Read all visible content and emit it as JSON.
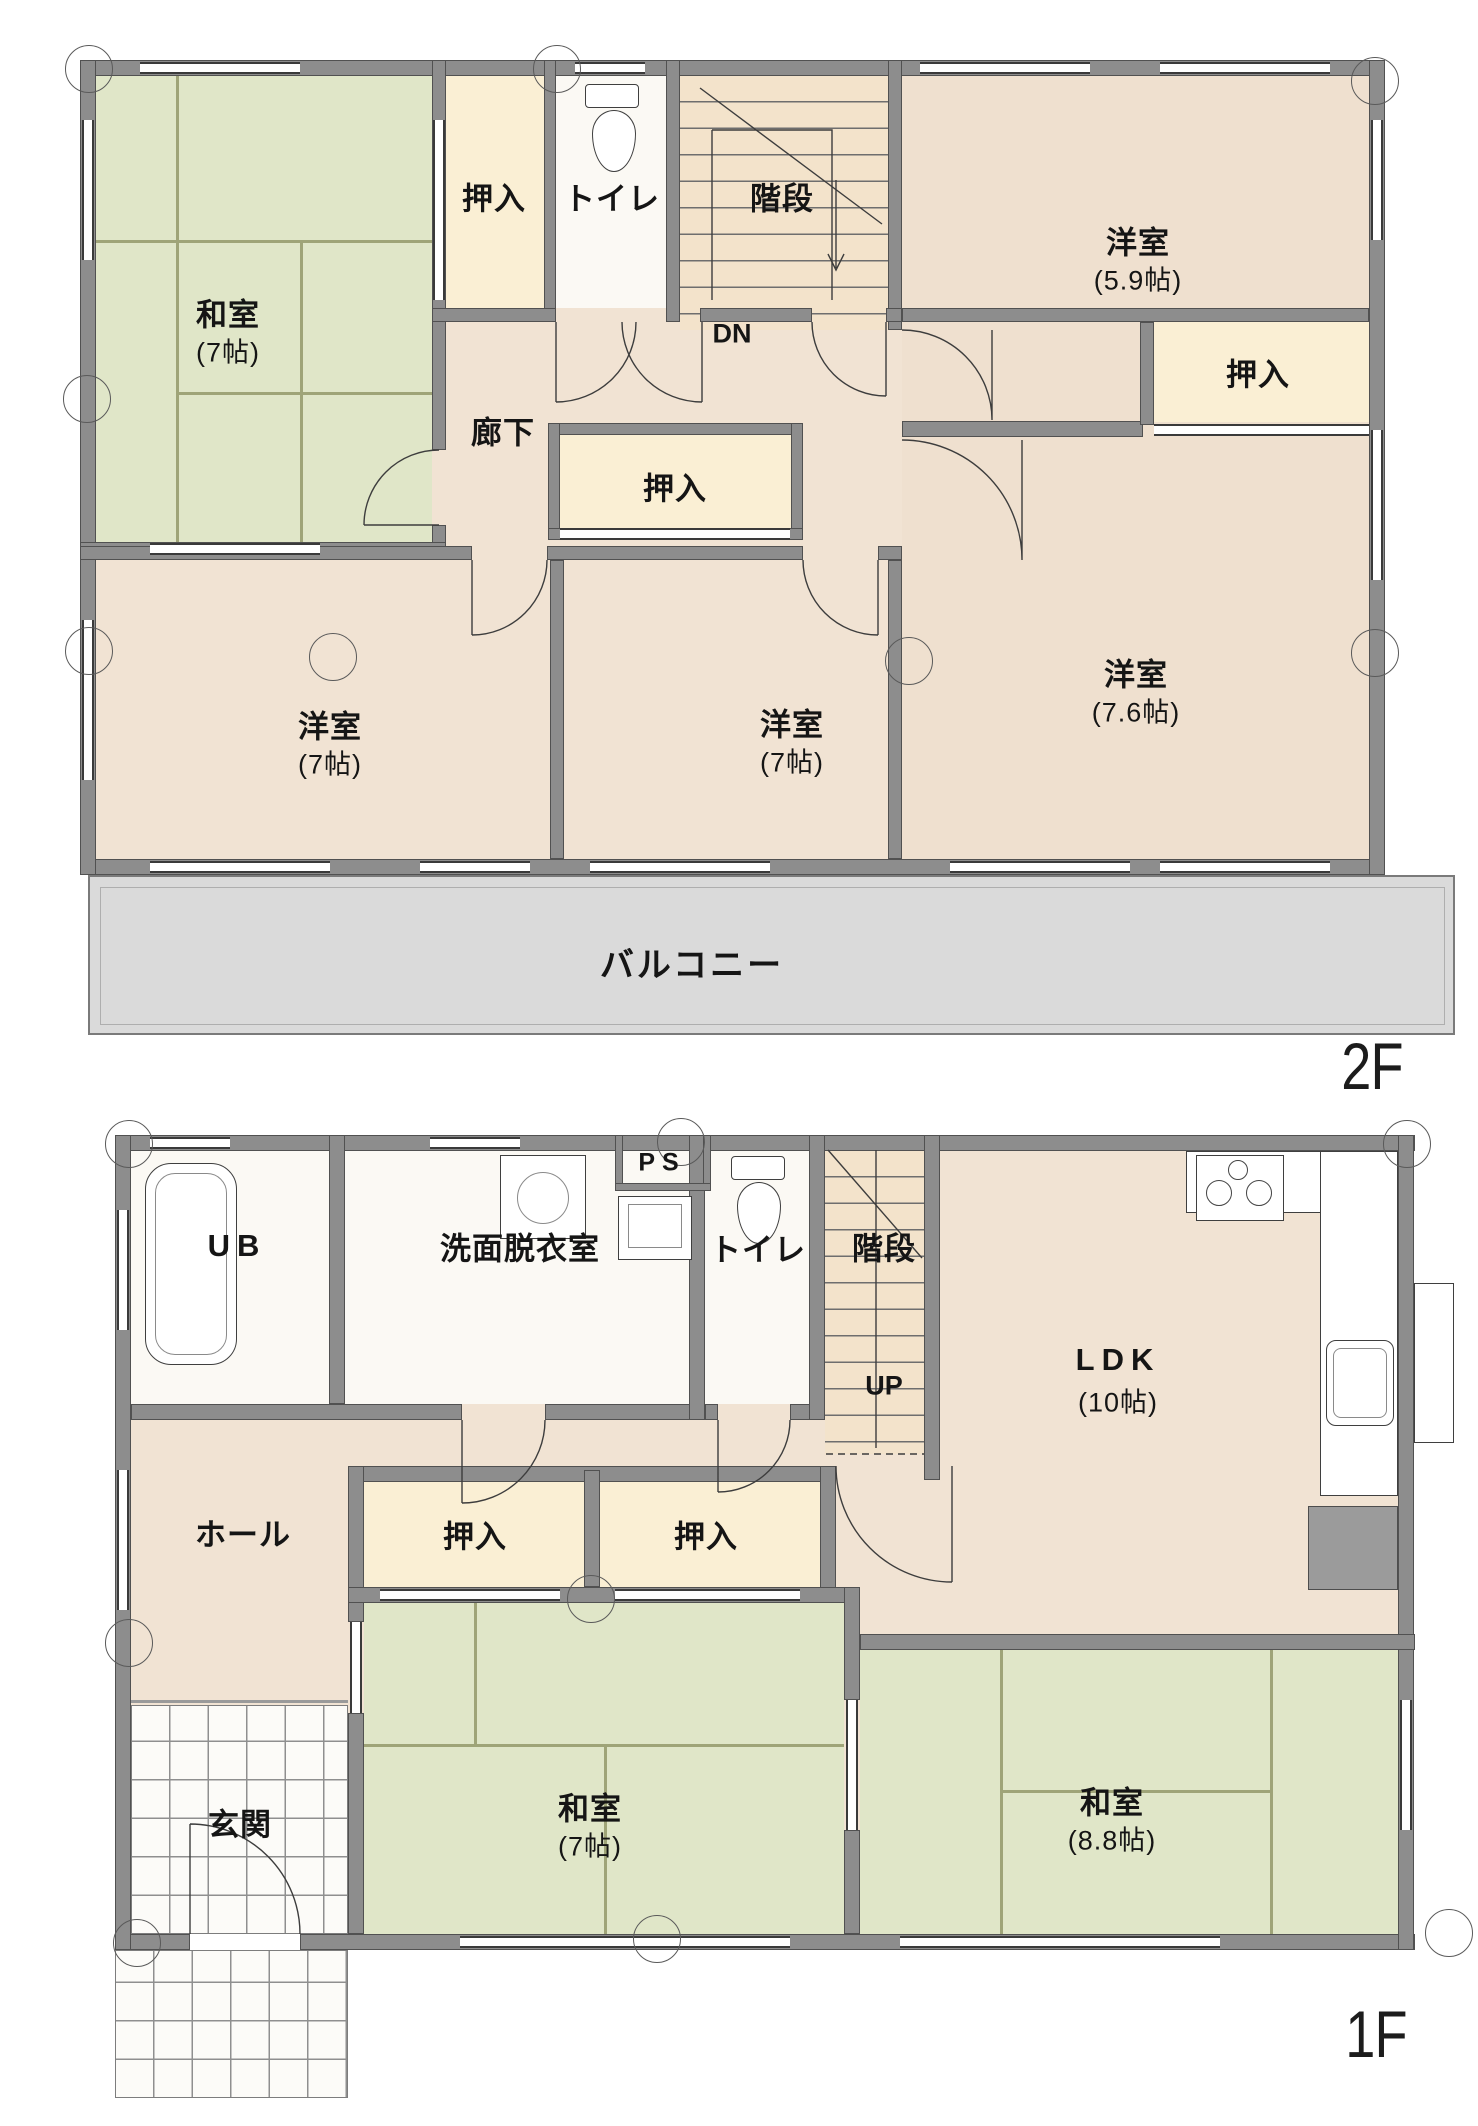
{
  "title": "間取り図",
  "colors": {
    "wall": "#8d8d8d",
    "tatami": "#e0e6c8",
    "wood_floor": "#f1e3d3",
    "closet": "#faefd4",
    "balcony": "#dadada",
    "white_room": "#fbf9f4"
  },
  "plan_2f": {
    "floor_label": "2F",
    "washitsu7": {
      "name": "和室",
      "size": "(7帖)"
    },
    "oshiire_top": {
      "name": "押入"
    },
    "toilet": {
      "name": "トイレ"
    },
    "stairs": {
      "name": "階段",
      "direction": "DN"
    },
    "rouka": {
      "name": "廊下"
    },
    "oshiire_mid": {
      "name": "押入"
    },
    "yoshitsu59": {
      "name": "洋室",
      "size": "(5.9帖)"
    },
    "oshiire_right": {
      "name": "押入"
    },
    "yoshitsu7a": {
      "name": "洋室",
      "size": "(7帖)"
    },
    "yoshitsu7b": {
      "name": "洋室",
      "size": "(7帖)"
    },
    "yoshitsu76": {
      "name": "洋室",
      "size": "(7.6帖)"
    },
    "balcony": {
      "name": "バルコニー"
    }
  },
  "plan_1f": {
    "floor_label": "1F",
    "ub": {
      "name": "UB"
    },
    "senmen": {
      "name": "洗面脱衣室"
    },
    "ps": {
      "name": "PS"
    },
    "toilet": {
      "name": "トイレ"
    },
    "stairs": {
      "name": "階段",
      "direction": "UP"
    },
    "ldk": {
      "name": "LDK",
      "size": "(10帖)"
    },
    "hall": {
      "name": "ホール"
    },
    "oshiire_left": {
      "name": "押入"
    },
    "oshiire_right": {
      "name": "押入"
    },
    "washitsu7": {
      "name": "和室",
      "size": "(7帖)"
    },
    "washitsu88": {
      "name": "和室",
      "size": "(8.8帖)"
    },
    "genkan": {
      "name": "玄関"
    }
  }
}
